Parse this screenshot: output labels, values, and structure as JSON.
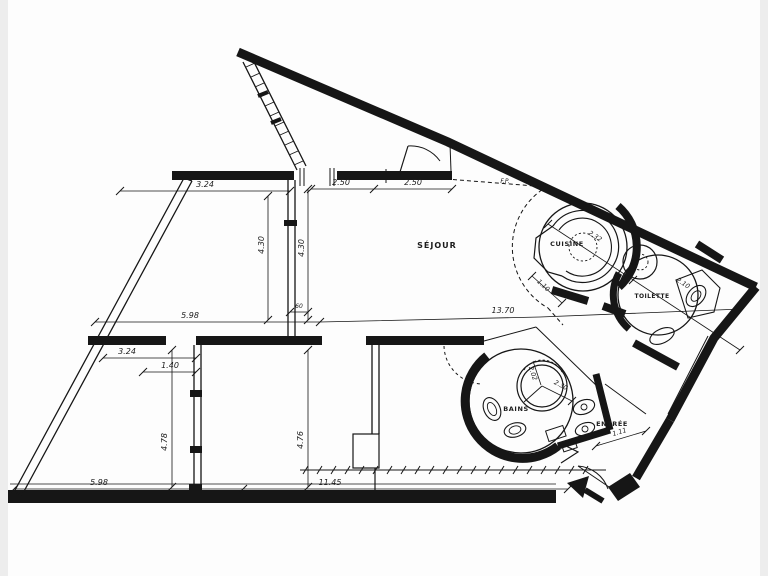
{
  "figure": {
    "type": "architectural floor plan",
    "style": "black ink line drawing on white paper"
  },
  "colors": {
    "ink": "#161616",
    "paper": "#fdfdfd",
    "edge_shade": "#e3e3e3"
  },
  "rooms": {
    "sejour": "SÉJOUR",
    "cuisine": "CUISINE",
    "toilette": "TOILETTE",
    "bains": "BAINS",
    "entree": "ENTRÉE",
    "flue": "F.P."
  },
  "dimensions": {
    "top_left_width": "3.24",
    "top_bay_1": "2.50",
    "top_bay_2": "2.50",
    "left_room_width": "5.98",
    "overall_length": "13.70",
    "lower_left_width": "3.24",
    "lower_left_door": "1.40",
    "bottom_left_width": "5.98",
    "bottom_main_width": "11.45",
    "left_room_depth": "4.30",
    "sejour_depth": "4.30",
    "lower_left_depth": "4.78",
    "lower_mid_depth": "4.76",
    "cuisine_width": "2.32",
    "toilette_width": "2.10",
    "tub_dim_radial": "2.30",
    "tub_dim_chord": "2.02",
    "entree_width": "1.11",
    "passage_width": "1.10",
    "small_dim": "60"
  }
}
